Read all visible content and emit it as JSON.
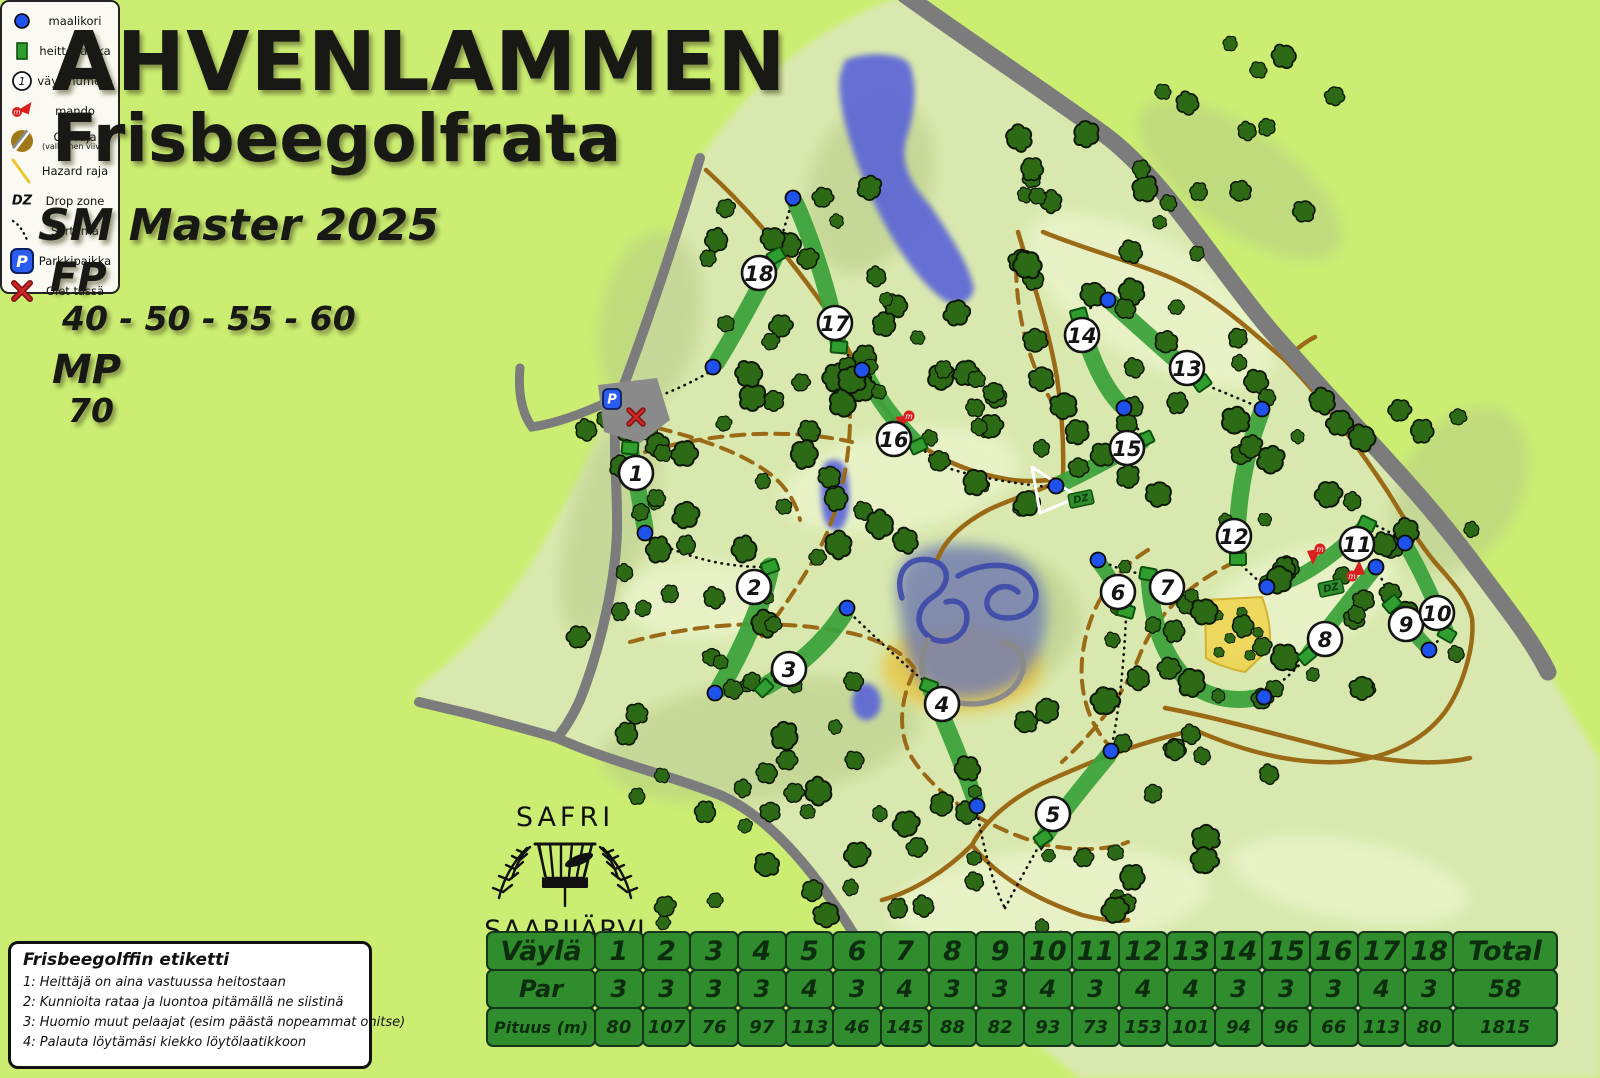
{
  "title": {
    "line1": "AHVENLAMMEN",
    "line2": "Frisbeegolfrata",
    "event": "SM Master 2025",
    "fp_label": "FP",
    "fp_values": "40 - 50 - 55 - 60",
    "mp_label": "MP",
    "mp_values": "70"
  },
  "logo": {
    "top": "SAFRI",
    "bottom": "SAARIJÄRVI"
  },
  "etiquette": {
    "title": "Frisbeegolffin etiketti",
    "rules": [
      "1: Heittäjä on aina vastuussa heitostaan",
      "2: Kunnioita rataa ja luontoa pitämällä ne siistinä",
      "3: Huomio muut pelaajat (esim päästä nopeammat ohitse)",
      "4: Palauta löytämäsi kiekko löytölaatikkoon"
    ]
  },
  "legend": {
    "items": [
      {
        "icon": "basket-icon",
        "label": "maalikori"
      },
      {
        "icon": "tee-icon",
        "label": "heittopaikka"
      },
      {
        "icon": "hole-number-icon",
        "label": "väylänumero",
        "symbol": "1"
      },
      {
        "icon": "mando-icon",
        "label": "mando",
        "symbol": "m"
      },
      {
        "icon": "ob-icon",
        "label": "OB-raja",
        "sublabel": "(valkoinen viiva)"
      },
      {
        "icon": "hazard-icon",
        "label": "Hazard raja"
      },
      {
        "icon": "dz-icon",
        "label": "Drop zone",
        "symbol": "DZ"
      },
      {
        "icon": "transition-icon",
        "label": "Siirtymä"
      },
      {
        "icon": "parking-icon",
        "label": "Parkkipaikka",
        "symbol": "P"
      },
      {
        "icon": "you-are-here-icon",
        "label": "Olet tässä"
      }
    ]
  },
  "scorecard": {
    "header_label": "Väylä",
    "par_label": "Par",
    "length_label": "Pituus (m)",
    "total_label": "Total",
    "holes": [
      "1",
      "2",
      "3",
      "4",
      "5",
      "6",
      "7",
      "8",
      "9",
      "10",
      "11",
      "12",
      "13",
      "14",
      "15",
      "16",
      "17",
      "18"
    ],
    "par": [
      "3",
      "3",
      "3",
      "3",
      "4",
      "3",
      "4",
      "3",
      "3",
      "4",
      "3",
      "4",
      "4",
      "3",
      "3",
      "3",
      "4",
      "3"
    ],
    "length_m": [
      "80",
      "107",
      "76",
      "97",
      "113",
      "46",
      "145",
      "88",
      "82",
      "93",
      "73",
      "153",
      "101",
      "94",
      "96",
      "66",
      "113",
      "80"
    ],
    "par_total": "58",
    "length_total": "1815"
  },
  "chart_data": {
    "type": "table",
    "title": "Ahvenlammen Frisbeegolfrata scorecard",
    "categories": [
      1,
      2,
      3,
      4,
      5,
      6,
      7,
      8,
      9,
      10,
      11,
      12,
      13,
      14,
      15,
      16,
      17,
      18
    ],
    "series": [
      {
        "name": "Par",
        "values": [
          3,
          3,
          3,
          3,
          4,
          3,
          4,
          3,
          3,
          4,
          3,
          4,
          4,
          3,
          3,
          3,
          4,
          3
        ]
      },
      {
        "name": "Pituus (m)",
        "values": [
          80,
          107,
          76,
          97,
          113,
          46,
          145,
          88,
          82,
          93,
          73,
          153,
          101,
          94,
          96,
          66,
          113,
          80
        ]
      }
    ],
    "totals": {
      "Par": 58,
      "Pituus (m)": 1815
    }
  },
  "map": {
    "colors": {
      "background": "#cbee72",
      "terrain": "#d9e8ae",
      "tree": "#2c6a16",
      "tree_edge": "#0c1506",
      "fairway": "#3aa23a",
      "tee": "#2f9e2f",
      "tee_edge": "#0e5210",
      "basket": "#1f52ea",
      "road": "#7c7c7c",
      "trail": "#9a6a16",
      "lake": "#5a63d8",
      "hazard": "#f0d245",
      "badge_bg": "#ffffff",
      "badge_edge": "#141414",
      "mando": "#d92020",
      "parking": "#2b5cf0"
    },
    "terrain_path": "M700,158 C760,70 830,20 905,-5 C975,45 1040,88 1105,135 C1165,180 1215,265 1270,330 C1318,385 1360,430 1405,480 C1432,510 1460,545 1482,575 C1508,610 1532,640 1548,672 L1600,760 L1600,1078 L1080,1078 C1010,1020 940,980 880,978 C860,950 855,935 843,917 C805,860 765,815 720,795 C670,775 610,762 557,738 L419,702 L415,690 C440,670 480,640 520,580 C560,520 595,450 617,390 C640,330 665,260 700,158 Z",
    "shade_dark": [
      [
        610,
        520,
        40,
        120,
        15
      ],
      [
        760,
        740,
        160,
        60,
        -8
      ],
      [
        990,
        620,
        90,
        70,
        0
      ],
      [
        1240,
        180,
        120,
        50,
        35
      ],
      [
        870,
        185,
        60,
        90,
        20
      ],
      [
        1460,
        490,
        60,
        90,
        30
      ],
      [
        650,
        320,
        50,
        90,
        10
      ]
    ],
    "shade_light": [
      [
        900,
        480,
        120,
        50,
        -10
      ],
      [
        1150,
        300,
        140,
        60,
        30
      ],
      [
        700,
        600,
        80,
        40,
        0
      ],
      [
        1300,
        600,
        100,
        50,
        -20
      ],
      [
        1050,
        900,
        160,
        50,
        -5
      ],
      [
        1350,
        880,
        120,
        40,
        10
      ]
    ],
    "lakes": [
      {
        "path": "M845,60 C865,52 895,52 908,62 C918,80 916,110 906,140 C900,165 912,185 930,205 C950,235 968,262 974,288 C972,302 958,308 944,300 C918,282 890,240 868,190 C850,148 836,100 840,75 Z"
      },
      {
        "path": "M826,462 C838,456 846,462 848,478 C851,500 849,518 842,528 C832,534 824,526 822,508 C820,490 820,470 826,462 Z"
      },
      {
        "path": "M856,686 C866,680 876,684 880,696 C883,708 878,718 868,720 C858,721 852,712 852,700 Z"
      }
    ],
    "track": {
      "yellow": [
        962,
        668,
        80,
        44
      ],
      "blue_blob": "M900,610 C885,558 920,540 970,545 C1022,548 1050,572 1046,622 C1042,670 1010,700 958,698 C913,695 905,657 900,610 Z",
      "loops_blue": [
        "M902,598 C894,572 908,556 930,560 C952,564 950,586 934,596 C918,606 914,622 926,634 C940,648 962,640 966,624 C970,608 960,598 946,602",
        "M958,576 C985,560 1020,562 1032,582 C1043,600 1030,618 1008,618 C990,618 982,606 990,594 C997,585 1010,584 1018,592"
      ],
      "loops_gray": [
        "M928,640 C916,668 922,692 948,700 C978,710 1010,700 1020,678 C1028,660 1020,646 1002,642"
      ]
    },
    "roads": [
      {
        "d": "M905,-5 C975,45 1040,88 1105,135 C1165,180 1215,265 1270,330 C1318,385 1360,430 1405,480 C1432,510 1460,545 1482,575 C1508,610 1532,640 1548,672",
        "w": 17
      },
      {
        "d": "M700,158 C675,240 645,330 620,395 C610,430 618,480 617,530 C616,580 600,650 580,700 C570,722 562,732 557,738 C610,762 670,775 720,795 C765,815 805,860 843,917 C858,940 868,958 880,978",
        "w": 10
      },
      {
        "d": "M419,702 L470,714 C500,722 530,730 557,738",
        "w": 10
      },
      {
        "d": "M612,400 C580,415 552,424 532,427 C521,412 518,390 520,368",
        "w": 9
      }
    ],
    "trails_solid": [
      "M706,170 C748,208 790,258 828,312 C848,350 872,398 905,432 C932,458 972,474 1012,480",
      "M1018,232 C1034,285 1050,335 1057,378 C1062,412 1064,445 1063,478",
      "M1043,232 C1092,252 1145,265 1180,282 C1218,300 1252,332 1285,360 C1322,398 1355,442 1388,492 C1408,525 1425,552 1440,568 C1455,585 1468,600 1472,618 C1475,648 1462,688 1445,712 C1420,745 1380,760 1340,762 C1290,764 1240,750 1195,730",
      "M1285,360 C1295,350 1305,342 1315,337",
      "M1195,730 C1140,742 1095,760 1050,780 C1015,795 985,820 972,845",
      "M972,845 C945,872 912,892 882,900",
      "M972,845 C998,878 1038,900 1082,915 C1102,920 1118,922 1128,920",
      "M1165,708 C1230,720 1300,742 1365,756 C1410,764 1445,764 1470,758",
      "M1012,480 C1030,482 1046,481 1063,478",
      "M1063,478 C1040,492 1012,498 988,510 C962,524 945,540 938,558"
    ],
    "trails_dashed": [
      "M645,452 C715,432 790,428 852,442",
      "M846,360 C856,425 848,492 820,548 C800,585 778,615 762,636",
      "M630,642 C700,623 775,618 850,633 C882,640 904,653 914,668",
      "M914,672 C900,700 897,732 912,758 C938,798 988,828 1042,844 C1078,852 1108,850 1128,842",
      "M1235,562 C1192,582 1158,612 1141,652 C1124,696 1094,732 1062,762",
      "M1016,268 C1017,320 1030,366 1052,402",
      "M1148,550 C1106,576 1086,616 1082,660 C1079,700 1093,734 1120,756",
      "M658,428 C705,440 748,455 775,478 C788,490 797,505 800,520"
    ],
    "hazard_zone": {
      "path": "M1205,600 L1262,597 C1270,618 1272,640 1268,650 L1245,672 C1225,668 1212,662 1206,658 Z",
      "trees": [
        [
          1218,
          615
        ],
        [
          1242,
          612
        ],
        [
          1258,
          632
        ],
        [
          1230,
          638
        ],
        [
          1250,
          655
        ],
        [
          1219,
          652
        ]
      ]
    },
    "ob_triangle": "M1032,467 L1078,497 L1040,513 Z",
    "parking": {
      "poly": "598,385 657,378 670,420 640,443 604,432",
      "p_icon": [
        612,
        399
      ],
      "x_icon": [
        636,
        417
      ]
    },
    "holes": [
      {
        "n": "1",
        "badge": [
          636,
          473
        ],
        "tee": [
          630,
          448,
          5
        ],
        "basket": [
          645,
          533
        ],
        "path": "M630,448 C636,478 641,505 645,528",
        "w": 17
      },
      {
        "n": "2",
        "badge": [
          754,
          587
        ],
        "tee": [
          770,
          567,
          -20
        ],
        "basket": [
          715,
          693
        ],
        "path": "M770,567 C763,605 742,650 720,688",
        "w": 19
      },
      {
        "n": "3",
        "badge": [
          789,
          669
        ],
        "tee": [
          764,
          688,
          -45
        ],
        "basket": [
          847,
          608
        ],
        "path": "M766,686 C798,667 827,640 844,613",
        "w": 19
      },
      {
        "n": "4",
        "badge": [
          942,
          704
        ],
        "tee": [
          929,
          686,
          20
        ],
        "basket": [
          977,
          806
        ],
        "path": "M930,688 C945,722 962,762 975,800",
        "w": 17
      },
      {
        "n": "5",
        "badge": [
          1053,
          814
        ],
        "tee": [
          1043,
          838,
          -35
        ],
        "basket": [
          1111,
          751
        ],
        "path": "M1045,836 C1065,808 1088,780 1108,756",
        "w": 17
      },
      {
        "n": "6",
        "badge": [
          1118,
          592
        ],
        "tee": [
          1126,
          611,
          15
        ],
        "basket": [
          1098,
          560
        ],
        "path": "M1125,608 C1117,590 1108,574 1100,564",
        "w": 15
      },
      {
        "n": "7",
        "badge": [
          1167,
          587
        ],
        "tee": [
          1148,
          574,
          10
        ],
        "basket": [
          1264,
          697
        ],
        "path": "M1149,577 C1152,625 1165,665 1197,688 C1222,703 1247,700 1260,697",
        "w": 17
      },
      {
        "n": "8",
        "badge": [
          1325,
          639
        ],
        "tee": [
          1307,
          656,
          -40
        ],
        "basket": [
          1376,
          567
        ],
        "path": "M1309,653 C1330,624 1353,596 1373,571",
        "w": 15
      },
      {
        "n": "9",
        "badge": [
          1406,
          624
        ],
        "tee": [
          1392,
          604,
          -40
        ],
        "basket": [
          1429,
          650
        ],
        "path": "M1394,607 C1406,624 1418,638 1427,647",
        "w": 15
      },
      {
        "n": "10",
        "badge": [
          1437,
          613
        ],
        "tee": [
          1447,
          634,
          30
        ],
        "basket": [
          1405,
          543
        ],
        "path": "M1446,630 C1434,600 1420,570 1407,547",
        "w": 15
      },
      {
        "n": "11",
        "badge": [
          1357,
          544
        ],
        "tee": [
          1367,
          524,
          25
        ],
        "basket": [
          1267,
          587
        ],
        "path": "M1365,526 C1342,548 1312,572 1288,581 C1280,584 1272,586 1268,587",
        "w": 15
      },
      {
        "n": "12",
        "badge": [
          1234,
          536
        ],
        "tee": [
          1238,
          559,
          0
        ],
        "basket": [
          1262,
          409
        ],
        "path": "M1238,556 C1235,515 1243,460 1261,413",
        "w": 17
      },
      {
        "n": "13",
        "badge": [
          1187,
          368
        ],
        "tee": [
          1202,
          383,
          -35
        ],
        "basket": [
          1108,
          300
        ],
        "path": "M1199,380 C1172,357 1140,328 1112,303",
        "w": 17
      },
      {
        "n": "14",
        "badge": [
          1082,
          335
        ],
        "tee": [
          1079,
          315,
          -15
        ],
        "basket": [
          1124,
          408
        ],
        "path": "M1080,318 C1088,350 1100,382 1120,404",
        "w": 17
      },
      {
        "n": "15",
        "badge": [
          1127,
          448
        ],
        "tee": [
          1145,
          439,
          -25
        ],
        "basket": [
          1056,
          486
        ],
        "path": "M1142,441 C1115,456 1085,472 1060,484",
        "w": 17
      },
      {
        "n": "16",
        "badge": [
          894,
          439
        ],
        "tee": [
          918,
          446,
          -25
        ],
        "basket": [
          862,
          370
        ],
        "path": "M916,443 C898,425 878,400 866,375",
        "w": 17
      },
      {
        "n": "17",
        "badge": [
          835,
          323
        ],
        "tee": [
          839,
          347,
          5
        ],
        "basket": [
          793,
          198
        ],
        "path": "M838,342 C830,295 813,243 796,204",
        "w": 17
      },
      {
        "n": "18",
        "badge": [
          759,
          273
        ],
        "tee": [
          776,
          256,
          -30
        ],
        "basket": [
          713,
          367
        ],
        "path": "M774,259 C757,292 737,330 717,362",
        "w": 17
      }
    ],
    "transitions": [
      "M708,373 C685,386 663,395 650,399",
      "M636,430 C633,438 631,443 630,446",
      "M648,538 C690,560 730,567 764,567",
      "M721,694 L757,690",
      "M850,613 C878,640 905,665 924,681",
      "M977,812 C985,855 995,890 1005,908",
      "M1005,908 C1017,885 1030,862 1040,844",
      "M1112,745 C1120,705 1124,660 1126,618",
      "M1104,562 C1120,570 1135,573 1143,574",
      "M1269,692 C1283,681 1295,670 1303,661",
      "M1379,573 C1384,584 1388,594 1391,601",
      "M1432,646 C1437,642 1441,638 1444,636",
      "M1400,539 C1390,532 1380,527 1372,524",
      "M1261,583 C1252,575 1245,569 1240,563",
      "M1256,406 C1238,398 1220,391 1206,385",
      "M1102,301 C1094,306 1087,310 1082,313",
      "M1126,413 C1133,422 1138,429 1142,435",
      "M1048,487 C1010,483 970,476 945,467 C935,460 926,452 921,448",
      "M857,365 C851,358 845,352 841,349",
      "M791,205 C786,222 781,239 777,251"
    ],
    "transition_arrow": [
      1040,
      844,
      -55
    ],
    "mandos": [
      [
        909,
        416,
        140
      ],
      [
        1320,
        549,
        135
      ],
      [
        1352,
        576,
        -45
      ]
    ],
    "dz_markers": [
      [
        1081,
        499
      ],
      [
        1331,
        588
      ]
    ],
    "forest": [
      [
        575,
        415,
        280,
        300,
        42
      ],
      [
        620,
        715,
        290,
        220,
        26
      ],
      [
        700,
        180,
        260,
        230,
        30
      ],
      [
        980,
        240,
        300,
        270,
        38
      ],
      [
        1010,
        520,
        280,
        270,
        32
      ],
      [
        1290,
        390,
        190,
        300,
        24
      ],
      [
        900,
        760,
        330,
        230,
        26
      ],
      [
        1060,
        40,
        280,
        190,
        16
      ],
      [
        845,
        310,
        150,
        240,
        16
      ],
      [
        990,
        120,
        90,
        100,
        6
      ]
    ]
  }
}
